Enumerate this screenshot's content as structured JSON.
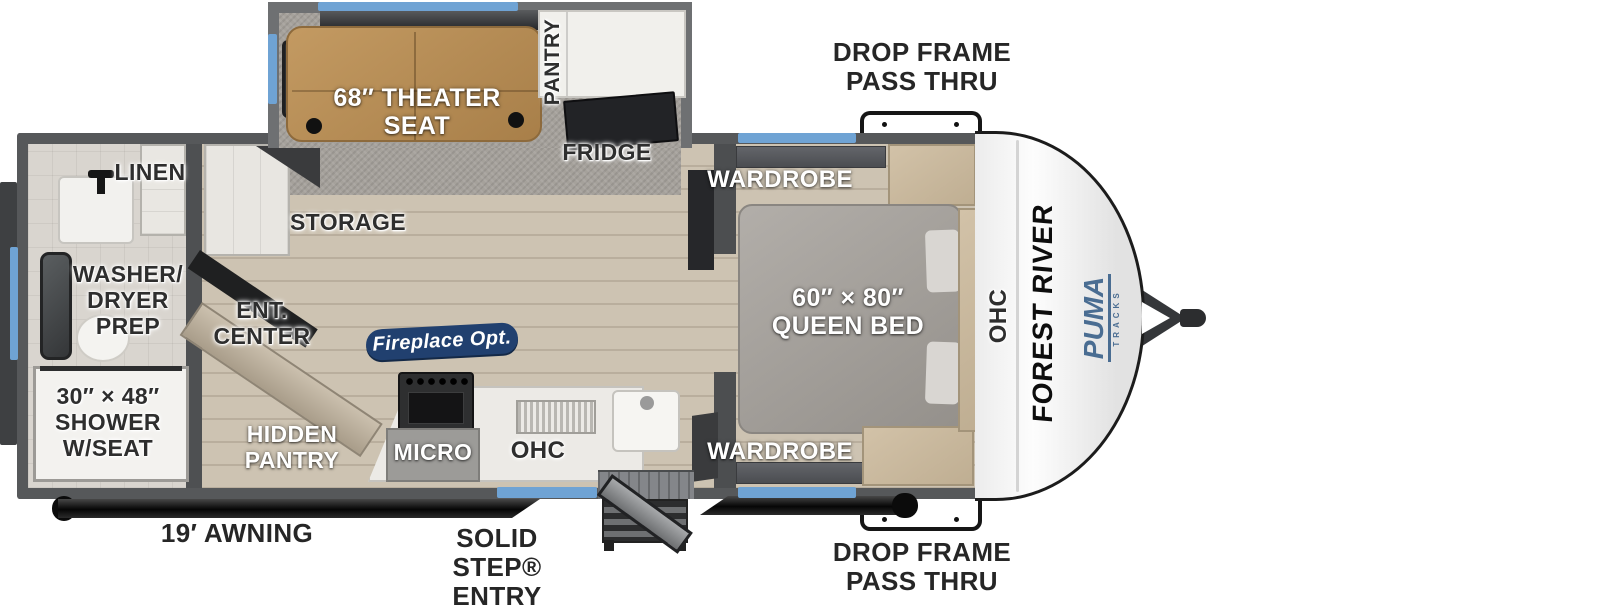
{
  "title": "Forest River Puma travel trailer floor plan",
  "labels": {
    "drop_frame_top": "DROP FRAME PASS THRU",
    "drop_frame_bottom": "DROP FRAME PASS THRU",
    "awning": "19′ AWNING",
    "solid_step_entry": "SOLID STEP® ENTRY",
    "linen": "LINEN",
    "washer_dryer_prep": "WASHER/ DRYER PREP",
    "shower": "30″ × 48″ SHOWER W/SEAT",
    "ent_center": "ENT. CENTER",
    "storage": "STORAGE",
    "hidden_pantry": "HIDDEN PANTRY",
    "fireplace_opt": "Fireplace Opt.",
    "micro": "MICRO",
    "ohc_kitchen": "OHC",
    "theater_seat": "68″ THEATER SEAT",
    "pantry": "PANTRY",
    "fridge": "FRIDGE",
    "wardrobe_top": "WARDROBE",
    "wardrobe_bottom": "WARDROBE",
    "queen_bed": "60″ × 80″ QUEEN BED",
    "ohc_bedroom": "OHC",
    "forest_river": "FOREST RIVER",
    "puma": "PUMA",
    "puma_tracks": "TRACKS"
  },
  "colors": {
    "accent_blue": "#6fa3d4",
    "badge_navy": "#21406f",
    "wall_gray": "#56585a",
    "floor_tan": "#c9bead",
    "seat_tan": "#b78e55",
    "cabinet_beige": "#c9b99f",
    "brand_blue": "#4a6d92"
  }
}
